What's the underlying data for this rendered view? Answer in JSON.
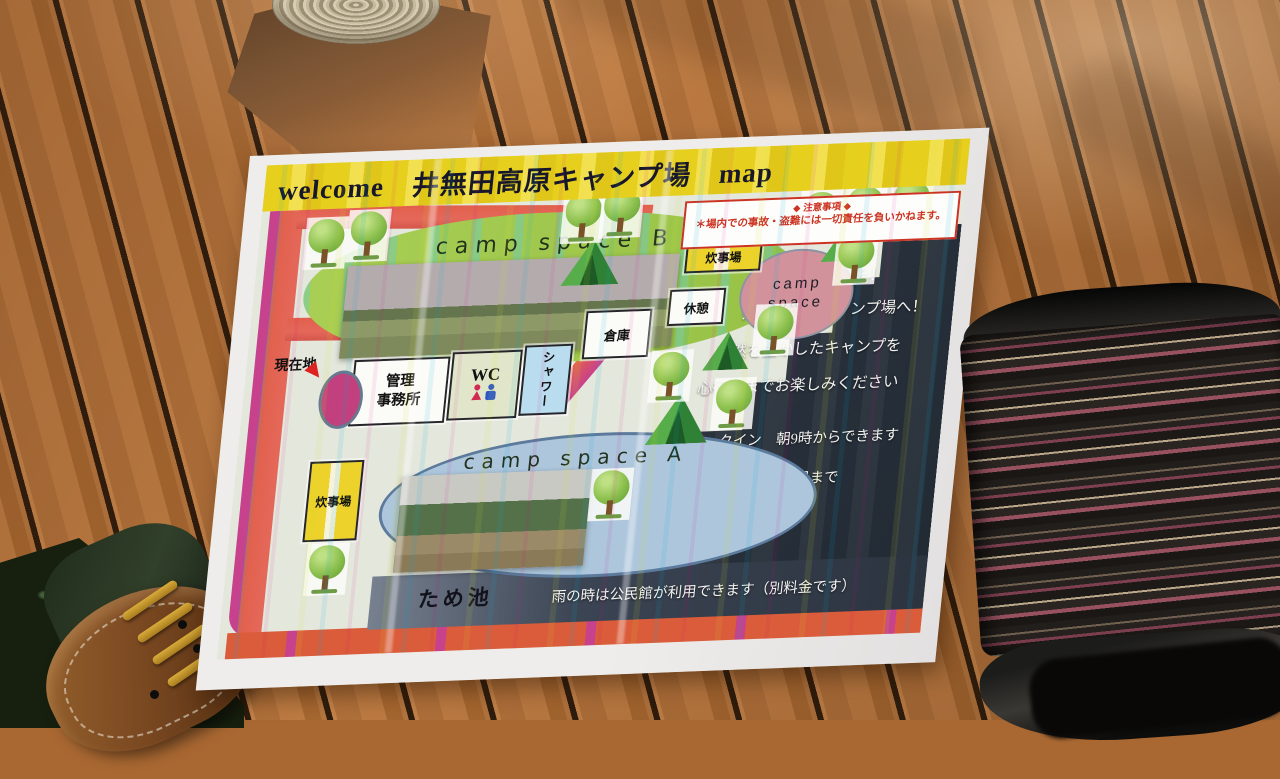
{
  "map": {
    "title": "welcome　井無田高原キャンプ場　map",
    "notice": {
      "heading": "◆ 注意事項 ◆",
      "body": "＊場内での事故・盗難には一切責任を負いかねます。"
    },
    "areas": {
      "camp_space_b": "camp space B",
      "camp_space_a": "camp space A",
      "camp_circle_line1": "camp",
      "camp_circle_line2": "space",
      "pond": "ため池"
    },
    "buildings": {
      "evacuation_hut": "避難小屋",
      "cooking_area_upper": "炊事場",
      "cooking_area_lower": "炊事場",
      "office_line1": "管理",
      "office_line2": "事務所",
      "wc": "WC",
      "shower": "シャワー",
      "warehouse": "倉庫",
      "rest": "休憩"
    },
    "markers": {
      "current_location": "現在地"
    },
    "info_panel": {
      "lines": [
        "ようこそ！",
        "井無田高原キャンプ場へ！",
        "自然を生かしたキャンプを",
        "心行くまでお楽しみください",
        "チェックイン　朝9時からできます",
        "チェックアウト　お昼まで"
      ],
      "rain_note": "雨の時は公民館が利用できます（別料金です）"
    },
    "icons": {
      "tree": "tree-icon",
      "tent": "tent-icon",
      "wc_female": "female-icon",
      "wc_male": "male-icon",
      "current_location_arrow": "arrow-icon"
    },
    "colors": {
      "title_yellow": "#e7cf1e",
      "notice_red": "#cc3322",
      "road_red": "#e2604c",
      "road_magenta": "#c8418c",
      "field_green": "#a9ce55",
      "space_a_blue": "#adc6dc",
      "circle_pink": "#d2929b",
      "panel_dark": "#272f3a",
      "pond_navy": "#3b4453",
      "box_yellow": "#ecd22a",
      "box_pink": "#e46cc5",
      "shower_blue": "#b9dcee"
    }
  }
}
